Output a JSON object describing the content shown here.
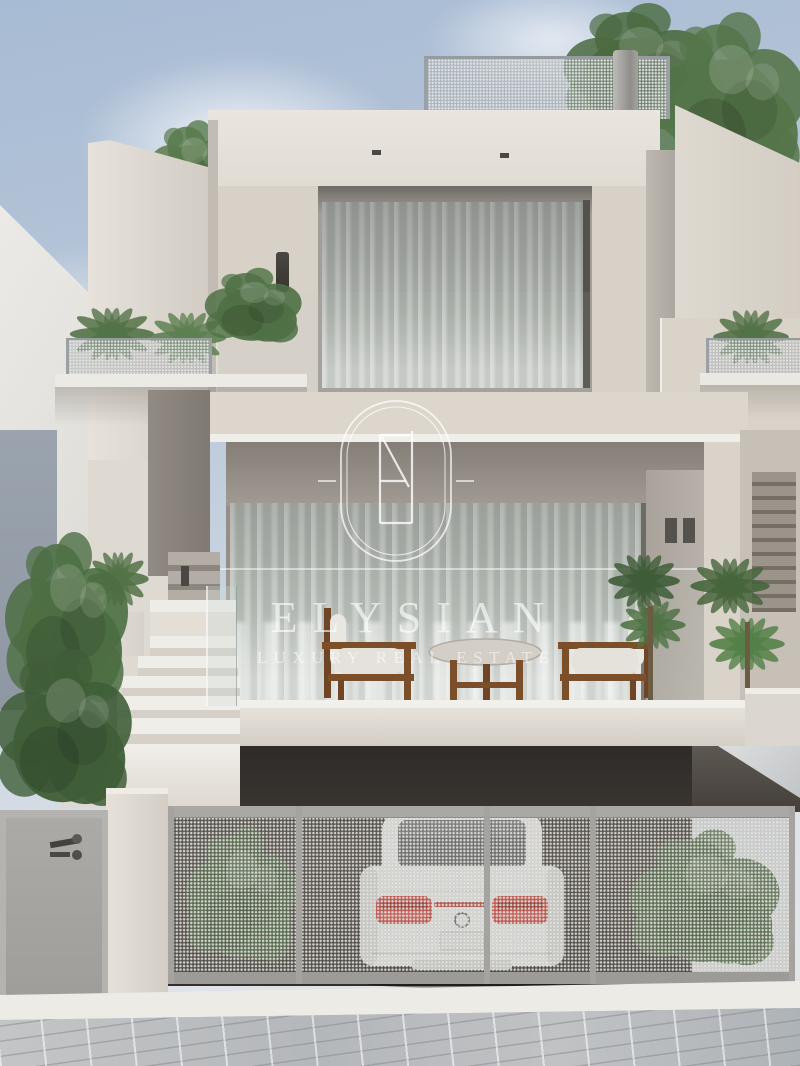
{
  "meta": {
    "type": "architectural-render",
    "subject": "modern multi-level villa exterior with rooftop terrace, curtained glass walls, planted balconies and basement garage with white sports car",
    "style": "photorealistic 3D rendering, beige stucco, daylight"
  },
  "watermark": {
    "brand": "ELYSIAN",
    "tagline": "LUXURY REAL ESTATE",
    "monogram": "EN",
    "badge": "double-line stadium oval with flanking dashes",
    "text_color": "rgba(255,255,255,0.62)"
  },
  "palette": {
    "sky_top": "#a7bbd4",
    "sky_bottom": "#e6e8ea",
    "facade_light": "#e2ddd5",
    "facade_mid": "#d7d1c8",
    "facade_shadow": "#a39e97",
    "recess_dark": "#8a847d",
    "curtain_gray": "#b7bcb6",
    "garage_dark": "#3a3531",
    "mesh_gray": "#a9a8a5",
    "car_body": "#edf0ef",
    "taillight_red": "#cf3a31",
    "foliage_green": "#55764a",
    "pavement_gray": "#bcbfc1",
    "wood_brown": "#7c4f2b"
  },
  "scene": {
    "elements": [
      "sky with soft clouds",
      "neighboring building with sloped roof",
      "rooftop terrace with perforated metal railing, round pole and trees",
      "penthouse level with sheer-curtained glass wall and cylindrical wall sconce",
      "planted balconies with perforated railings and palms",
      "main terrace with sheer curtains, two wooden lounge chairs and round stone coffee table",
      "recessed side entrance with steps, glass balustrade and planter",
      "basement garage with perforated sliding gates and white car with red taillights",
      "perforated street fence with shrubs behind",
      "concrete pillar and grey pedestrian gate with handle",
      "stone paved sidewalk with white curb"
    ]
  }
}
